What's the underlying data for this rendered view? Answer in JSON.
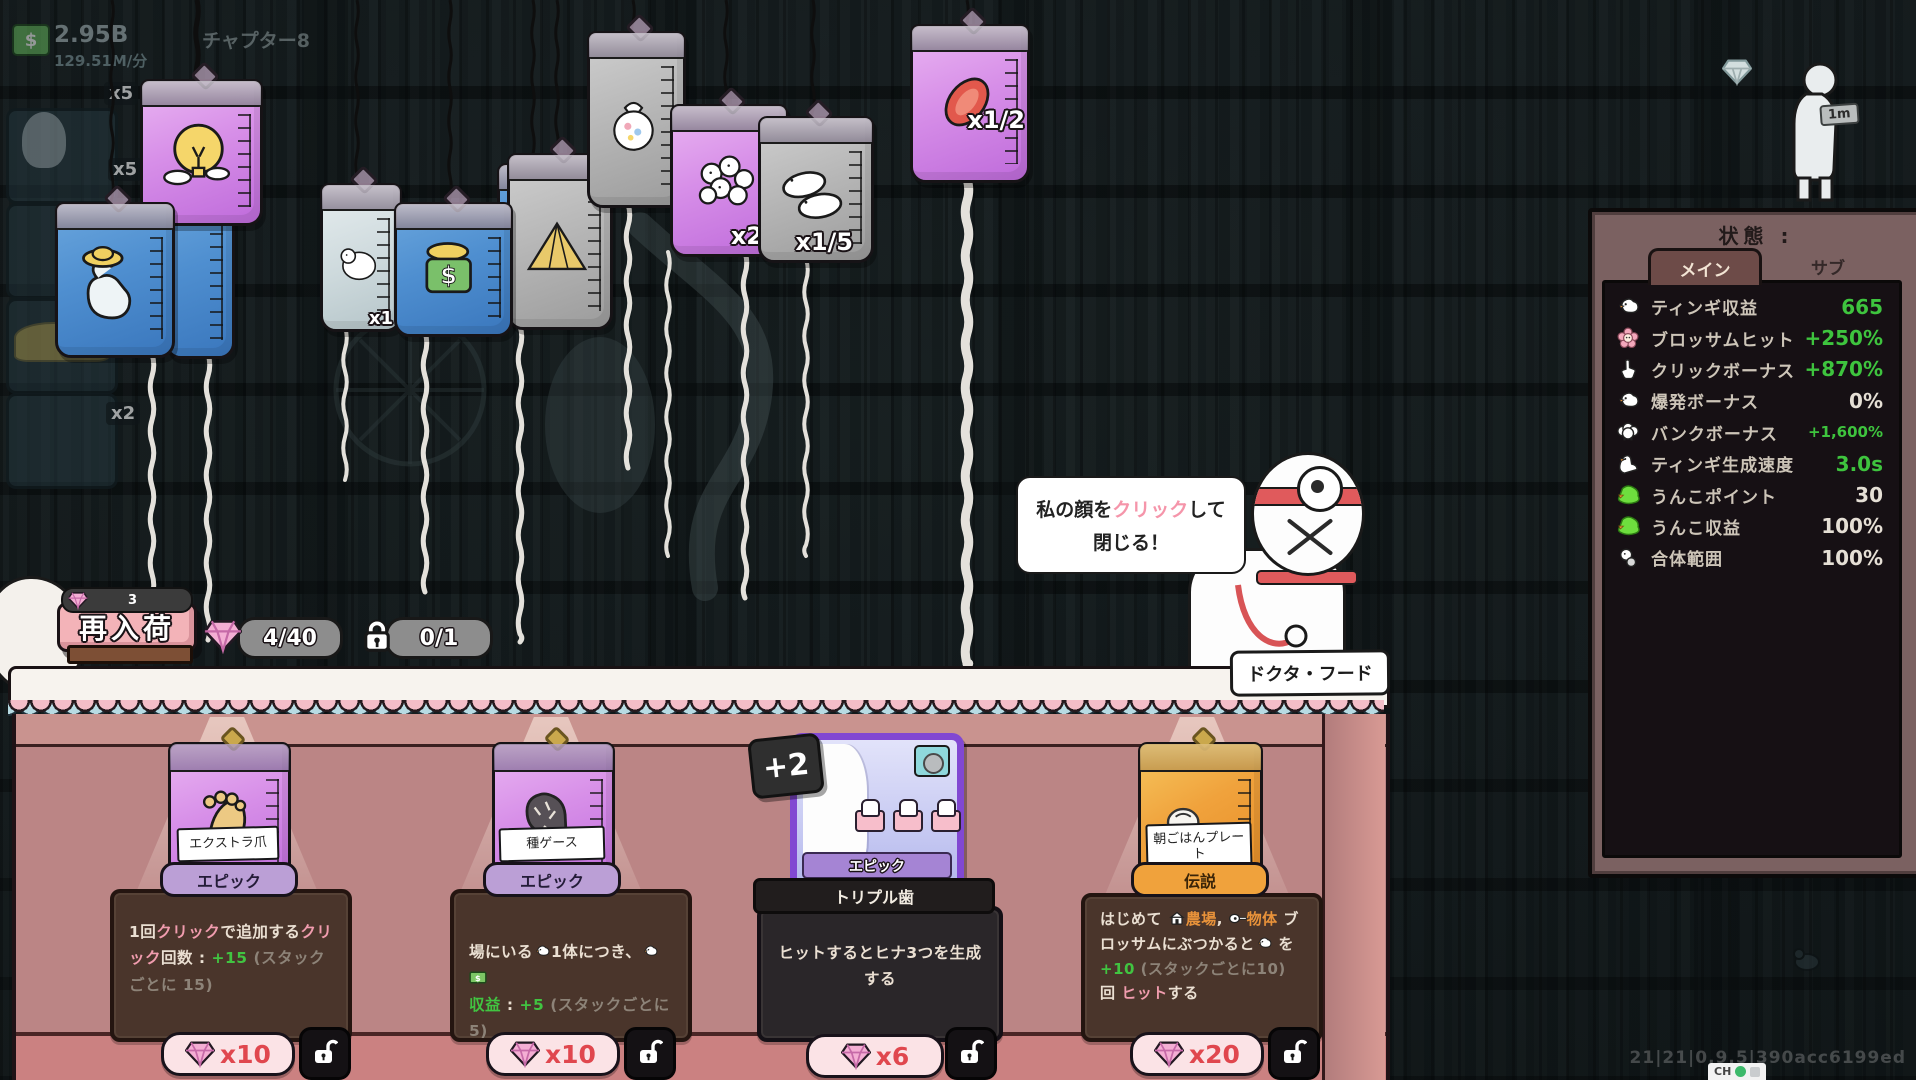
{
  "hud": {
    "money": "2.95B",
    "rate": "129.51M/分",
    "chapter": "チャプター8",
    "distance": "1m",
    "badges": [
      "x5",
      "x5",
      "x2"
    ]
  },
  "bags": [
    {
      "kind": "lightbulb",
      "multiplier": ""
    },
    {
      "kind": "blue-plain",
      "multiplier": ""
    },
    {
      "kind": "flex-hat",
      "multiplier": ""
    },
    {
      "kind": "polar-bear",
      "multiplier": "x1"
    },
    {
      "kind": "money-hat",
      "multiplier": ""
    },
    {
      "kind": "pyramid",
      "multiplier": ""
    },
    {
      "kind": "sack",
      "multiplier": ""
    },
    {
      "kind": "cluster",
      "multiplier": "x2"
    },
    {
      "kind": "ducks",
      "multiplier": "x1/5"
    },
    {
      "kind": "meat",
      "multiplier": "x1/2"
    }
  ],
  "bubble": {
    "pre": "私の顔を",
    "hl": "クリック",
    "post": "して",
    "line2": "閉じる！"
  },
  "doctor": {
    "name": "ドクタ・フード"
  },
  "shop": {
    "restock_label": "再入荷",
    "restock_count": "3",
    "gem_counter": "4/40",
    "lock_counter": "0/1",
    "items": [
      {
        "name": "エクストラ爪",
        "rarity": "エピック",
        "rarity_type": "epic",
        "price": "x10",
        "desc": [
          {
            "t": "1回",
            "c": "w"
          },
          {
            "t": "クリック",
            "c": "p"
          },
          {
            "t": "で追加する",
            "c": "w"
          },
          {
            "t": "クリック",
            "c": "p"
          },
          {
            "t": "回数 : ",
            "c": "w"
          },
          {
            "t": "+15 ",
            "c": "g"
          },
          {
            "t": "(スタックごとに 15)",
            "c": "gr"
          }
        ]
      },
      {
        "name": "種ゲース",
        "rarity": "エピック",
        "rarity_type": "epic",
        "price": "x10",
        "desc": [
          {
            "t": "場にいる",
            "c": "w"
          },
          {
            "i": "bird"
          },
          {
            "t": "1体につき、",
            "c": "w"
          },
          {
            "i": "bird"
          },
          {
            "i": "money"
          },
          {
            "br": true
          },
          {
            "t": "収益",
            "c": "g"
          },
          {
            "t": " : ",
            "c": "w"
          },
          {
            "t": "+5 ",
            "c": "g"
          },
          {
            "t": "(スタックごとに5)",
            "c": "gr"
          }
        ]
      },
      {
        "name": "トリプル歯",
        "rarity": "エピック",
        "rarity_type": "epic",
        "price": "x6",
        "badge": "+2",
        "desc": [
          {
            "t": "ヒットするとヒナ3つを生成",
            "c": "w"
          },
          {
            "br": true
          },
          {
            "t": "する",
            "c": "w"
          }
        ]
      },
      {
        "name": "朝ごはんプレート",
        "rarity": "伝説",
        "rarity_type": "legend",
        "price": "x20",
        "desc": [
          {
            "t": "はじめて ",
            "c": "w"
          },
          {
            "i": "farm"
          },
          {
            "t": "農場",
            "c": "o"
          },
          {
            "t": ", ",
            "c": "w"
          },
          {
            "i": "guitar"
          },
          {
            "t": "物体",
            "c": "o"
          },
          {
            "t": " ブロッサムにぶつかると",
            "c": "w"
          },
          {
            "i": "bird"
          },
          {
            "t": " を ",
            "c": "w"
          },
          {
            "t": "+10",
            "c": "g"
          },
          {
            "t": " (スタックごとに10)",
            "c": "gr"
          },
          {
            "t": " 回 ",
            "c": "w"
          },
          {
            "t": "ヒット",
            "c": "p"
          },
          {
            "t": "する",
            "c": "w"
          }
        ]
      }
    ]
  },
  "panel": {
    "title": "状態 :",
    "tab_main": "メイン",
    "tab_sub": "サブ",
    "rows": [
      {
        "icon": "bird",
        "label": "ティンギ収益",
        "value": "665",
        "color": "green"
      },
      {
        "icon": "blossom",
        "label": "ブロッサムヒット",
        "value": "+250%",
        "color": "green"
      },
      {
        "icon": "hand",
        "label": "クリックボーナス",
        "value": "+870%",
        "color": "green"
      },
      {
        "icon": "bird",
        "label": "爆発ボーナス",
        "value": "0%",
        "color": "white"
      },
      {
        "icon": "sheep",
        "label": "バンクボーナス",
        "value": "+1,600%",
        "color": "green",
        "small": true
      },
      {
        "icon": "goose",
        "label": "ティンギ生成速度",
        "value": "3.0s",
        "color": "green"
      },
      {
        "icon": "poop",
        "label": "うんこポイント",
        "value": "30",
        "color": "white"
      },
      {
        "icon": "poop",
        "label": "うんこ収益",
        "value": "100%",
        "color": "white"
      },
      {
        "icon": "merge",
        "label": "合体範囲",
        "value": "100%",
        "color": "white"
      }
    ]
  },
  "footer": {
    "version": "21|21|0.9.5|390acc6199ed",
    "ch": "CH"
  }
}
